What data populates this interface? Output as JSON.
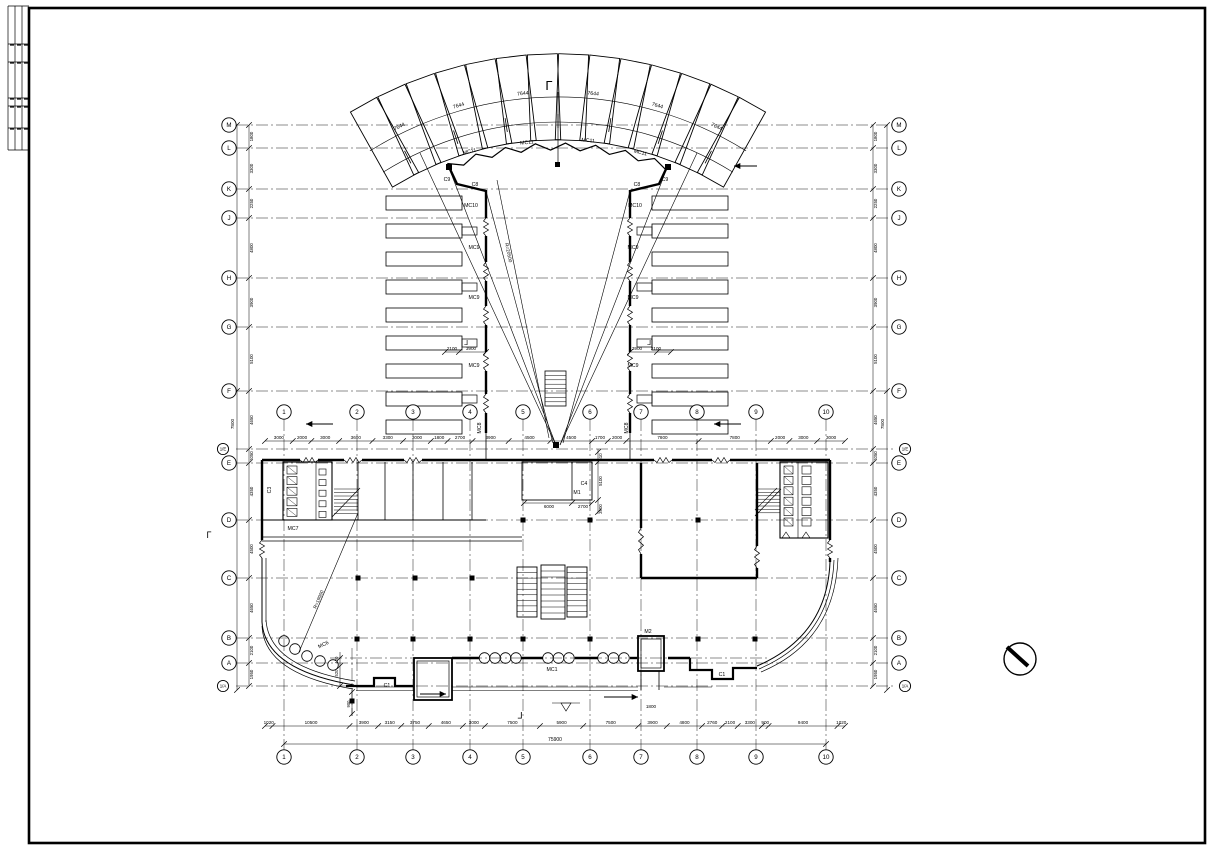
{
  "sheet": {
    "background": "#ffffff",
    "ink": "#000000"
  },
  "symbols": {
    "north_marker": "circle-with-slash"
  },
  "grid": {
    "left_rows": [
      {
        "label": "M",
        "y": 125
      },
      {
        "label": "L",
        "y": 148
      },
      {
        "label": "K",
        "y": 189
      },
      {
        "label": "J",
        "y": 218
      },
      {
        "label": "H",
        "y": 278
      },
      {
        "label": "G",
        "y": 327
      },
      {
        "label": "F",
        "y": 391
      },
      {
        "label": "1/E",
        "y": 449,
        "small": true
      },
      {
        "label": "E",
        "y": 463
      },
      {
        "label": "D",
        "y": 520
      },
      {
        "label": "C",
        "y": 578
      },
      {
        "label": "B",
        "y": 638
      },
      {
        "label": "A",
        "y": 663
      },
      {
        "label": "1/A",
        "y": 686,
        "small": true
      }
    ],
    "right_rows": [
      {
        "label": "M",
        "y": 125
      },
      {
        "label": "L",
        "y": 148
      },
      {
        "label": "K",
        "y": 189
      },
      {
        "label": "J",
        "y": 218
      },
      {
        "label": "H",
        "y": 278
      },
      {
        "label": "G",
        "y": 327
      },
      {
        "label": "F",
        "y": 391
      },
      {
        "label": "1/E",
        "y": 449,
        "small": true
      },
      {
        "label": "E",
        "y": 463
      },
      {
        "label": "D",
        "y": 520
      },
      {
        "label": "C",
        "y": 578
      },
      {
        "label": "B",
        "y": 638
      },
      {
        "label": "A",
        "y": 663
      },
      {
        "label": "1/A",
        "y": 686,
        "small": true
      }
    ],
    "columns": [
      {
        "label": "1",
        "x": 284
      },
      {
        "label": "2",
        "x": 357
      },
      {
        "label": "3",
        "x": 413
      },
      {
        "label": "4",
        "x": 470
      },
      {
        "label": "5",
        "x": 523
      },
      {
        "label": "6",
        "x": 590
      },
      {
        "label": "7",
        "x": 641
      },
      {
        "label": "8",
        "x": 697
      },
      {
        "label": "9",
        "x": 756
      },
      {
        "label": "10",
        "x": 826
      }
    ]
  },
  "dimensions": {
    "bottom": {
      "values": [
        "1020",
        "10500",
        "3900",
        "3150",
        "3750",
        "4650",
        "3000",
        "7500",
        "5900",
        "7500",
        "3900",
        "4800",
        "2760",
        "2100",
        "3300",
        "900",
        "9400",
        "1020"
      ],
      "total": "75900"
    },
    "middle": {
      "values": [
        "3000",
        "2000",
        "3000",
        "3600",
        "3300",
        "3000",
        "1800",
        "2700",
        "3900",
        "4500",
        "4500",
        "1700",
        "2000",
        "7800",
        "7800",
        "2000",
        "3000",
        "3000"
      ]
    },
    "left_column": {
      "values": [
        "1800",
        "3300",
        "2250",
        "4800",
        "3900",
        "5100",
        "4650",
        "1050",
        "4350",
        "4500",
        "4650",
        "2100",
        "1950"
      ],
      "outer_total": "7800"
    },
    "right_column": {
      "values": [
        "1800",
        "3300",
        "2250",
        "4800",
        "3900",
        "5100",
        "4650",
        "1050",
        "4350",
        "4500",
        "4650",
        "2100",
        "1950"
      ],
      "outer_total": "7800"
    }
  },
  "annotations": [
    {
      "t": "Γ",
      "x": 549,
      "y": 90,
      "s": 13
    },
    {
      "t": "7644",
      "x": 400,
      "y": 128,
      "r": -26
    },
    {
      "t": "7644",
      "x": 459,
      "y": 107,
      "r": -16
    },
    {
      "t": "7644",
      "x": 523,
      "y": 95,
      "r": -6
    },
    {
      "t": "7644",
      "x": 593,
      "y": 95,
      "r": 6
    },
    {
      "t": "7644",
      "x": 657,
      "y": 107,
      "r": 16
    },
    {
      "t": "7644",
      "x": 716,
      "y": 128,
      "r": 26
    },
    {
      "t": "MC11",
      "x": 470,
      "y": 153,
      "r": -14
    },
    {
      "t": "MC11",
      "x": 527,
      "y": 144,
      "r": -5
    },
    {
      "t": "MC11",
      "x": 588,
      "y": 142,
      "r": 5
    },
    {
      "t": "MC11",
      "x": 640,
      "y": 154,
      "r": 14
    },
    {
      "t": "C9",
      "x": 447,
      "y": 181
    },
    {
      "t": "C8",
      "x": 475,
      "y": 186
    },
    {
      "t": "C8",
      "x": 637,
      "y": 186
    },
    {
      "t": "C9",
      "x": 665,
      "y": 181
    },
    {
      "t": "MC10",
      "x": 471,
      "y": 207
    },
    {
      "t": "MC10",
      "x": 635,
      "y": 207
    },
    {
      "t": "MC9",
      "x": 474,
      "y": 249
    },
    {
      "t": "MC9",
      "x": 474,
      "y": 299
    },
    {
      "t": "MC9",
      "x": 474,
      "y": 367
    },
    {
      "t": "MC9",
      "x": 633,
      "y": 249
    },
    {
      "t": "MC9",
      "x": 633,
      "y": 299
    },
    {
      "t": "MC9",
      "x": 633,
      "y": 367
    },
    {
      "t": "2100",
      "x": 452,
      "y": 350,
      "s": 4.6
    },
    {
      "t": "3900",
      "x": 471,
      "y": 350,
      "s": 4.6
    },
    {
      "t": "3900",
      "x": 637,
      "y": 350,
      "s": 4.6
    },
    {
      "t": "2100",
      "x": 656,
      "y": 350,
      "s": 4.6
    },
    {
      "t": "MC8",
      "x": 481,
      "y": 428,
      "r": -90
    },
    {
      "t": "MC8",
      "x": 628,
      "y": 428,
      "r": -90
    },
    {
      "t": "R=20500",
      "x": 507,
      "y": 253,
      "r": 78,
      "s": 4.8
    },
    {
      "t": "R=19900",
      "x": 320,
      "y": 600,
      "r": -67,
      "s": 4.8
    },
    {
      "t": "C3",
      "x": 271,
      "y": 490,
      "r": -90
    },
    {
      "t": "MC7",
      "x": 293,
      "y": 530
    },
    {
      "t": "C4",
      "x": 584,
      "y": 485
    },
    {
      "t": "M1",
      "x": 577,
      "y": 494
    },
    {
      "t": "6000",
      "x": 549,
      "y": 508,
      "s": 4.6
    },
    {
      "t": "2700",
      "x": 583,
      "y": 508,
      "s": 4.6
    },
    {
      "t": "510",
      "x": 602,
      "y": 457,
      "r": -90,
      "s": 4.4
    },
    {
      "t": "5100",
      "x": 602,
      "y": 481,
      "r": -90,
      "s": 4.4
    },
    {
      "t": "3900",
      "x": 602,
      "y": 509,
      "r": -90,
      "s": 4.4
    },
    {
      "t": "MC6",
      "x": 324,
      "y": 646,
      "r": -25
    },
    {
      "t": "C1",
      "x": 387,
      "y": 687
    },
    {
      "t": "C1",
      "x": 722,
      "y": 676
    },
    {
      "t": "M2",
      "x": 648,
      "y": 633
    },
    {
      "t": "MC1",
      "x": 552,
      "y": 671
    },
    {
      "t": "1800",
      "x": 651,
      "y": 708,
      "s": 4.6
    },
    {
      "t": "120",
      "x": 338,
      "y": 660,
      "r": -90,
      "s": 4.2
    },
    {
      "t": "520",
      "x": 338,
      "y": 673,
      "r": -90,
      "s": 4.2
    },
    {
      "t": "900",
      "x": 350,
      "y": 704,
      "r": -90,
      "s": 4.2
    },
    {
      "t": "7800",
      "x": 234,
      "y": 424,
      "r": -90,
      "s": 4.6
    },
    {
      "t": "7800",
      "x": 884,
      "y": 424,
      "r": -90,
      "s": 4.6
    },
    {
      "t": "75900",
      "x": 555,
      "y": 741,
      "s": 5
    },
    {
      "t": "Γ",
      "x": 520,
      "y": 712,
      "r": 180,
      "s": 9
    },
    {
      "t": "Γ",
      "x": 209,
      "y": 538,
      "s": 9
    },
    {
      "t": "Γ",
      "x": 466,
      "y": 340,
      "r": 180,
      "s": 7
    },
    {
      "t": "Γ",
      "x": 649,
      "y": 340,
      "r": 180,
      "s": 7
    }
  ]
}
